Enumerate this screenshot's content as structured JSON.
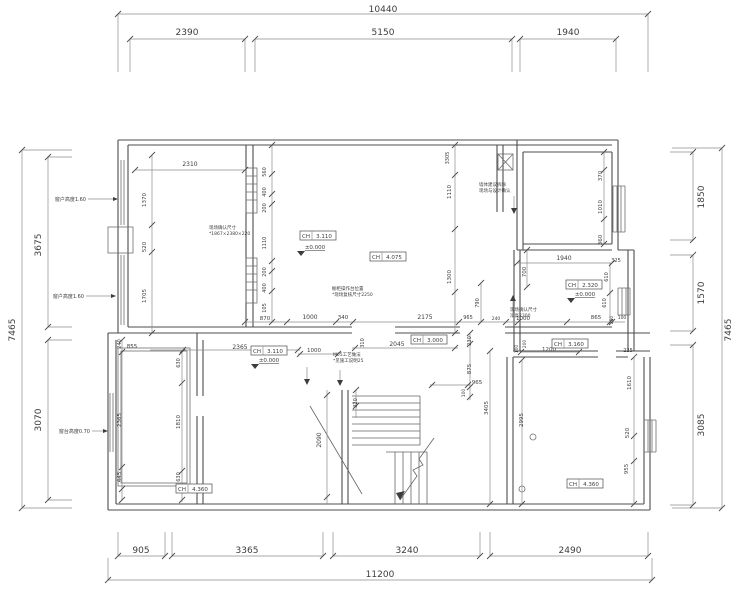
{
  "drawing": {
    "type": "architectural-floor-plan",
    "units": "mm",
    "outer_dimensions": {
      "top_overall": "10440",
      "top_segments": [
        "2390",
        "5150",
        "1940"
      ],
      "bottom_segments": [
        "905",
        "3365",
        "3240",
        "2490"
      ],
      "bottom_overall": "11200",
      "left_overall": "7465",
      "left_segments": [
        "3675",
        "3070"
      ],
      "right_segments": [
        "1850",
        "1570",
        "3085"
      ],
      "right_overall": "7465"
    },
    "labels": [
      {
        "t": "10440",
        "x": 383,
        "y": 12,
        "s": 9
      },
      {
        "t": "2390",
        "x": 187,
        "y": 35,
        "s": 9
      },
      {
        "t": "5150",
        "x": 383,
        "y": 35,
        "s": 9
      },
      {
        "t": "1940",
        "x": 568,
        "y": 35,
        "s": 9
      },
      {
        "t": "905",
        "x": 141,
        "y": 553,
        "s": 9
      },
      {
        "t": "3365",
        "x": 247,
        "y": 553,
        "s": 9
      },
      {
        "t": "3240",
        "x": 407,
        "y": 553,
        "s": 9
      },
      {
        "t": "2490",
        "x": 570,
        "y": 553,
        "s": 9
      },
      {
        "t": "11200",
        "x": 380,
        "y": 577,
        "s": 9
      },
      {
        "t": "7465",
        "x": 15,
        "y": 330,
        "v": 1,
        "s": 9
      },
      {
        "t": "3675",
        "x": 41,
        "y": 245,
        "v": 1,
        "s": 9
      },
      {
        "t": "3070",
        "x": 41,
        "y": 420,
        "v": 1,
        "s": 9
      },
      {
        "t": "1850",
        "x": 704,
        "y": 197,
        "v": 1,
        "s": 9
      },
      {
        "t": "1570",
        "x": 704,
        "y": 293,
        "v": 1,
        "s": 9
      },
      {
        "t": "3085",
        "x": 704,
        "y": 425,
        "v": 1,
        "s": 9
      },
      {
        "t": "7465",
        "x": 731,
        "y": 330,
        "v": 1,
        "s": 9
      },
      {
        "t": "2310",
        "x": 190,
        "y": 166,
        "s": 6
      },
      {
        "t": "1370",
        "x": 146,
        "y": 200,
        "v": 1,
        "s": 5.5
      },
      {
        "t": "520",
        "x": 146,
        "y": 247,
        "v": 1,
        "s": 5.5
      },
      {
        "t": "1705",
        "x": 146,
        "y": 296,
        "v": 1,
        "s": 5.5
      },
      {
        "t": "560",
        "x": 266,
        "y": 172,
        "v": 1,
        "s": 5
      },
      {
        "t": "400",
        "x": 266,
        "y": 192,
        "v": 1,
        "s": 5
      },
      {
        "t": "200",
        "x": 266,
        "y": 208,
        "v": 1,
        "s": 5
      },
      {
        "t": "1110",
        "x": 266,
        "y": 243,
        "v": 1,
        "s": 5
      },
      {
        "t": "200",
        "x": 266,
        "y": 272,
        "v": 1,
        "s": 5
      },
      {
        "t": "400",
        "x": 266,
        "y": 288,
        "v": 1,
        "s": 5
      },
      {
        "t": "105",
        "x": 266,
        "y": 308,
        "v": 1,
        "s": 5
      },
      {
        "t": "870",
        "x": 265,
        "y": 320,
        "s": 5.5
      },
      {
        "t": "1000",
        "x": 310,
        "y": 319,
        "s": 6
      },
      {
        "t": "340",
        "x": 343,
        "y": 319,
        "s": 5.5
      },
      {
        "t": "2175",
        "x": 425,
        "y": 319,
        "s": 6
      },
      {
        "t": "965",
        "x": 468,
        "y": 319,
        "s": 5
      },
      {
        "t": "790",
        "x": 479,
        "y": 303,
        "v": 1,
        "s": 5
      },
      {
        "t": "240",
        "x": 496,
        "y": 320,
        "s": 4.5
      },
      {
        "t": "1000",
        "x": 523,
        "y": 320,
        "s": 5.5
      },
      {
        "t": "1110",
        "x": 451,
        "y": 192,
        "v": 1,
        "s": 5.5
      },
      {
        "t": "1300",
        "x": 451,
        "y": 277,
        "v": 1,
        "s": 5.5
      },
      {
        "t": "3305",
        "x": 449,
        "y": 158,
        "v": 1,
        "s": 5
      },
      {
        "t": "370",
        "x": 602,
        "y": 176,
        "v": 1,
        "s": 5.5
      },
      {
        "t": "1010",
        "x": 602,
        "y": 207,
        "v": 1,
        "s": 5.5
      },
      {
        "t": "360",
        "x": 602,
        "y": 240,
        "v": 1,
        "s": 5.5
      },
      {
        "t": "1940",
        "x": 564,
        "y": 260,
        "s": 6
      },
      {
        "t": "700",
        "x": 526,
        "y": 272,
        "v": 1,
        "s": 5.5
      },
      {
        "t": "325",
        "x": 616,
        "y": 262,
        "s": 5
      },
      {
        "t": "610",
        "x": 608,
        "y": 277,
        "v": 1,
        "s": 5
      },
      {
        "t": "610",
        "x": 606,
        "y": 303,
        "v": 1,
        "s": 5
      },
      {
        "t": "865",
        "x": 596,
        "y": 319,
        "s": 5.5
      },
      {
        "t": "250",
        "x": 613,
        "y": 320,
        "v": 1,
        "s": 4.5
      },
      {
        "t": "100",
        "x": 622,
        "y": 319,
        "s": 4.5
      },
      {
        "t": "225",
        "x": 628,
        "y": 352,
        "s": 5
      },
      {
        "t": "2365",
        "x": 240,
        "y": 349,
        "s": 6
      },
      {
        "t": "1000",
        "x": 314,
        "y": 352,
        "s": 5.5
      },
      {
        "t": "310",
        "x": 364,
        "y": 343,
        "v": 1,
        "s": 5
      },
      {
        "t": "2045",
        "x": 397,
        "y": 346,
        "s": 6
      },
      {
        "t": "230",
        "x": 471,
        "y": 341,
        "v": 1,
        "s": 5
      },
      {
        "t": "875",
        "x": 471,
        "y": 369,
        "v": 1,
        "s": 5.5
      },
      {
        "t": "965",
        "x": 477,
        "y": 384,
        "s": 5.5
      },
      {
        "t": "100",
        "x": 465,
        "y": 393,
        "v": 1,
        "s": 4.5
      },
      {
        "t": "3405",
        "x": 488,
        "y": 408,
        "v": 1,
        "s": 5.5
      },
      {
        "t": "200",
        "x": 526,
        "y": 344,
        "v": 1,
        "s": 4.5
      },
      {
        "t": "100",
        "x": 518,
        "y": 349,
        "v": 1,
        "s": 4.5
      },
      {
        "t": "1200",
        "x": 549,
        "y": 351,
        "s": 5.5
      },
      {
        "t": "855",
        "x": 132,
        "y": 348,
        "s": 5.5
      },
      {
        "t": "240",
        "x": 121,
        "y": 344,
        "v": 1,
        "s": 5
      },
      {
        "t": "2365",
        "x": 121,
        "y": 420,
        "v": 1,
        "s": 5.5
      },
      {
        "t": "445",
        "x": 121,
        "y": 477,
        "v": 1,
        "s": 5.5
      },
      {
        "t": "630",
        "x": 180,
        "y": 363,
        "v": 1,
        "s": 5
      },
      {
        "t": "1810",
        "x": 180,
        "y": 422,
        "v": 1,
        "s": 5.5
      },
      {
        "t": "630",
        "x": 180,
        "y": 477,
        "v": 1,
        "s": 5
      },
      {
        "t": "2090",
        "x": 321,
        "y": 440,
        "v": 1,
        "s": 6
      },
      {
        "t": "320",
        "x": 357,
        "y": 403,
        "v": 1,
        "s": 5
      },
      {
        "t": "2995",
        "x": 523,
        "y": 420,
        "v": 1,
        "s": 5.5
      },
      {
        "t": "1610",
        "x": 631,
        "y": 383,
        "v": 1,
        "s": 5.5
      },
      {
        "t": "520",
        "x": 629,
        "y": 433,
        "v": 1,
        "s": 5.5
      },
      {
        "t": "955",
        "x": 628,
        "y": 469,
        "v": 1,
        "s": 5.5
      }
    ],
    "ch_labels": [
      {
        "label": "CH",
        "value": "3.110",
        "x": 318,
        "y": 236
      },
      {
        "label": "CH",
        "value": "4.075",
        "x": 388,
        "y": 257
      },
      {
        "label": "CH",
        "value": "2.320",
        "x": 584,
        "y": 285
      },
      {
        "label": "CH",
        "value": "3.000",
        "x": 429,
        "y": 340
      },
      {
        "label": "CH",
        "value": "3.110",
        "x": 269,
        "y": 351
      },
      {
        "label": "CH",
        "value": "3.160",
        "x": 570,
        "y": 344
      },
      {
        "label": "CH",
        "value": "4.360",
        "x": 194,
        "y": 489
      },
      {
        "label": "CH",
        "value": "4.360",
        "x": 585,
        "y": 484
      }
    ],
    "level_marks": [
      {
        "text": "±0.000",
        "x": 315,
        "y": 249
      },
      {
        "text": "±0.000",
        "x": 269,
        "y": 362
      },
      {
        "text": "±0.000",
        "x": 585,
        "y": 296
      }
    ],
    "callouts": [
      {
        "text": "窗户高度1.60",
        "x": 86,
        "y": 201,
        "lx": 88,
        "ax": 118,
        "ly": 199
      },
      {
        "text": "窗户高度1.60",
        "x": 84,
        "y": 298,
        "lx": 86,
        "ax": 116,
        "ly": 296
      },
      {
        "text": "窗台高度0.70",
        "x": 90,
        "y": 433,
        "lx": 92,
        "ax": 108,
        "ly": 431
      }
    ],
    "notes": [
      {
        "x": 209,
        "y": 229,
        "lines": [
          "现场确认尺寸",
          "*1867×2380×220"
        ]
      },
      {
        "x": 332,
        "y": 290,
        "lines": [
          "橱柜操作台位置",
          "*现场复核尺寸2250"
        ]
      },
      {
        "x": 479,
        "y": 186,
        "lines": [
          "墙体建议拆除",
          "现场与设计确认"
        ]
      },
      {
        "x": 510,
        "y": 311,
        "lines": [
          "现场确认尺寸",
          "净高2300"
        ]
      },
      {
        "x": 333,
        "y": 356,
        "lines": [
          "M05工艺做法",
          "*见施工说明25"
        ]
      }
    ]
  }
}
